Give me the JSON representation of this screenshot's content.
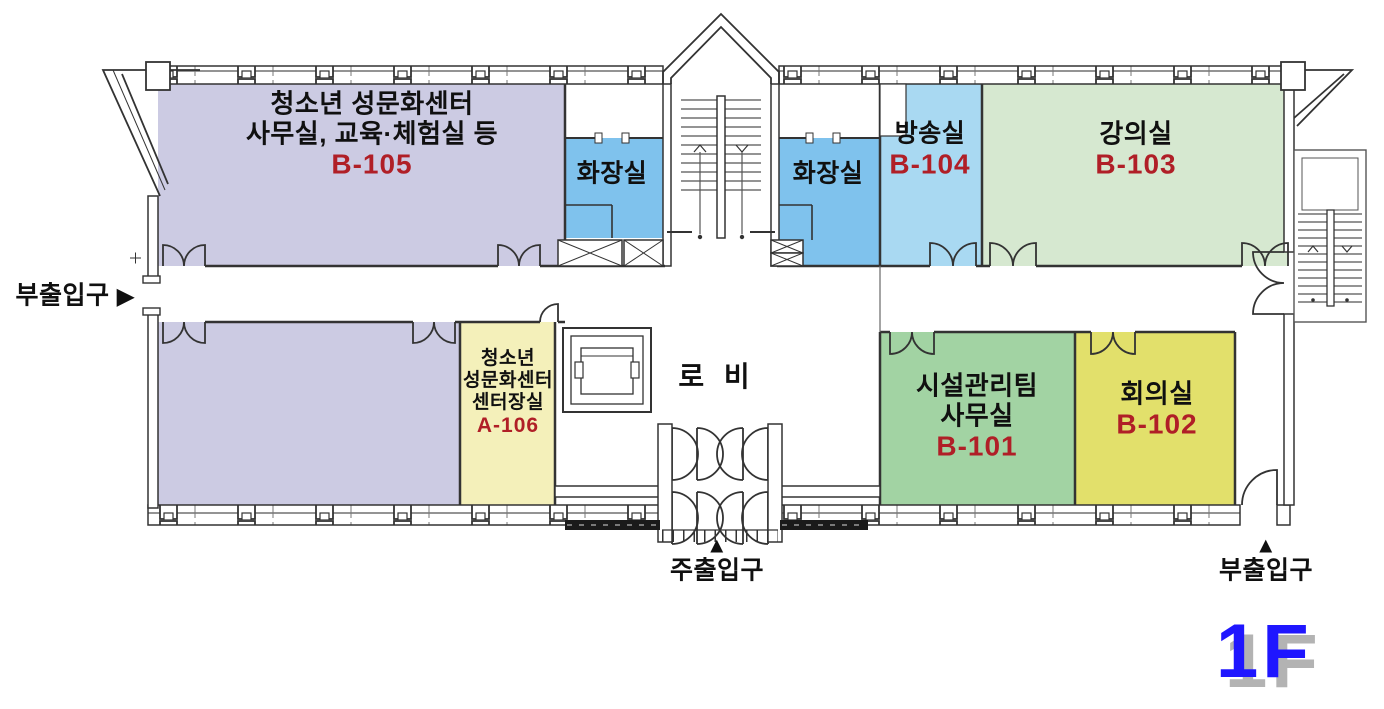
{
  "floor_plan": {
    "floor_badge": "1F",
    "badge_color": "#1f16ff",
    "badge_shadow_color": "#b3b3b3",
    "room_number_color": "#b01f27",
    "label_color": "#101010"
  },
  "rooms": {
    "b105": {
      "line1": "청소년 성문화센터",
      "line2": "사무실, 교육·체험실 등",
      "number": "B-105",
      "color": "#cccbe3"
    },
    "toilet_left": {
      "name": "화장실",
      "color": "#7fc2ed"
    },
    "toilet_right": {
      "name": "화장실",
      "color": "#7fc2ed"
    },
    "b104": {
      "name": "방송실",
      "number": "B-104",
      "color": "#a9d9f2"
    },
    "b103": {
      "name": "강의실",
      "number": "B-103",
      "color": "#d6e8d0"
    },
    "annex": {
      "color": "#cccbe3"
    },
    "a106": {
      "line1": "청소년",
      "line2": "성문화센터",
      "line3": "센터장실",
      "number": "A-106",
      "color": "#f4f0ba"
    },
    "lobby": {
      "name": "로 비"
    },
    "b101": {
      "line1": "시설관리팀",
      "line2": "사무실",
      "number": "B-101",
      "color": "#a2d3a3"
    },
    "b102": {
      "name": "회의실",
      "number": "B-102",
      "color": "#e2e06b"
    }
  },
  "entrances": {
    "side_left": {
      "label": "부출입구",
      "arrow": "▶"
    },
    "main": {
      "label": "주출입구",
      "arrow": "▲"
    },
    "side_right": {
      "label": "부출입구",
      "arrow": "▲"
    }
  }
}
